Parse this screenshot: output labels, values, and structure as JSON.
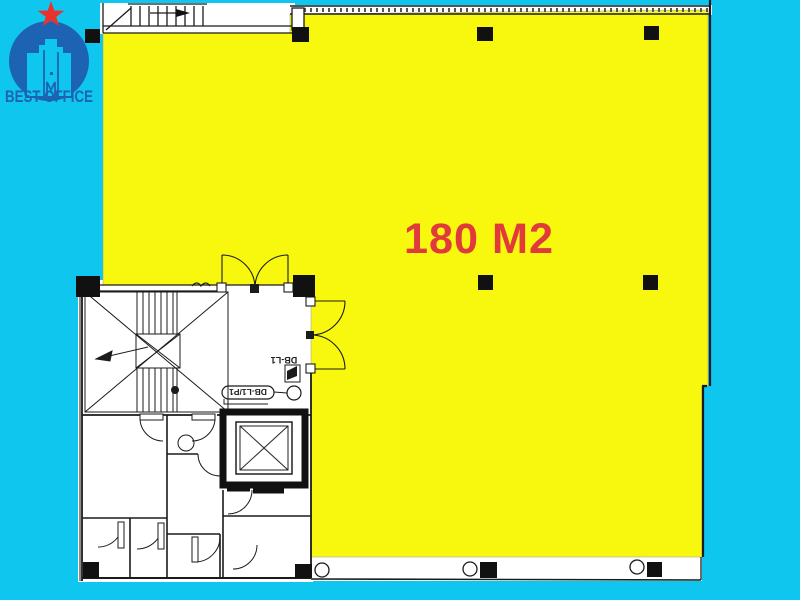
{
  "logo": {
    "brand": "BEST OFFICE",
    "star_color": "#e8322e",
    "brand_color": "#1c63b4"
  },
  "plan": {
    "area_label": "180 M2",
    "db_label": "DB-L1",
    "db_circuit_label": "DB-L1/P1"
  },
  "colors": {
    "background": "#0fc6ef",
    "highlight_area": "#f8f70e",
    "area_label_color": "#e03a3c",
    "line": "#1b1b1b"
  }
}
